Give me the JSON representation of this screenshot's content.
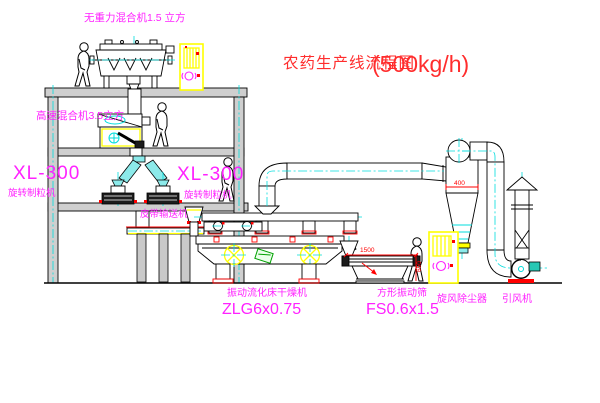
{
  "title": {
    "text": "农药生产线流程图",
    "capacity": "(500kg/h)"
  },
  "labels": {
    "mixer_top": "无重力混合机1.5 立方",
    "mixer_mid": "高速混合机3.5立方",
    "granulator_left_model": "XL-300",
    "granulator_left_name": "旋转制粒机",
    "granulator_right_model": "XL-300",
    "granulator_right_name": "旋转制粒机",
    "belt_conveyor": "皮带输送机",
    "dryer_name": "振动流化床干燥机",
    "dryer_model": "ZLG6x0.75",
    "screen_name": "方形振动筛",
    "screen_model": "FS0.6x1.5",
    "cyclone_name": "旋风除尘器",
    "fan_name": "引风机"
  },
  "dims": {
    "screen_length": "1500",
    "screen_height": "650",
    "cyclone_dia": "400"
  },
  "colors": {
    "label": "#ff22ff",
    "title": "#ff2d2d",
    "dimension": "#ff0000",
    "centerline": "#00dcdc",
    "cabinet": "#ffff00",
    "line": "#000000",
    "background": "#ffffff"
  }
}
